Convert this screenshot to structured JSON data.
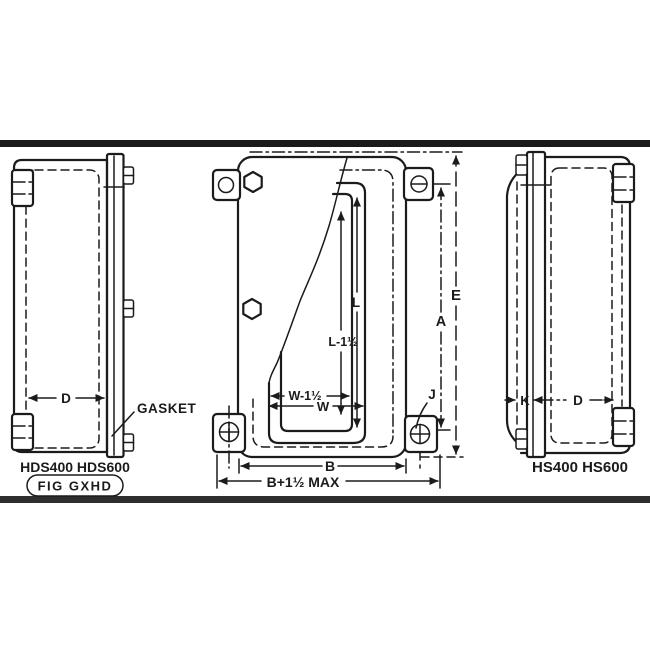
{
  "colors": {
    "ink": "#1b1b1b",
    "paper": "#ffffff",
    "scan_border_top": "#1a1a1a",
    "scan_border_bottom": "#2e2e2e"
  },
  "left_view": {
    "models": "HDS400 HDS600",
    "figure": "FIG GXHD",
    "gasket": "GASKET",
    "dim_d": "D"
  },
  "front_view": {
    "dim_e": "E",
    "dim_a": "A",
    "dim_l": "L",
    "dim_l_minus": "L-1½",
    "dim_w_minus": "W-1½",
    "dim_w": "W",
    "dim_b": "B",
    "dim_b_max": "B+1½ MAX",
    "dim_j": "J"
  },
  "right_view": {
    "models": "HS400 HS600",
    "dim_k": "K",
    "dim_d": "D"
  }
}
